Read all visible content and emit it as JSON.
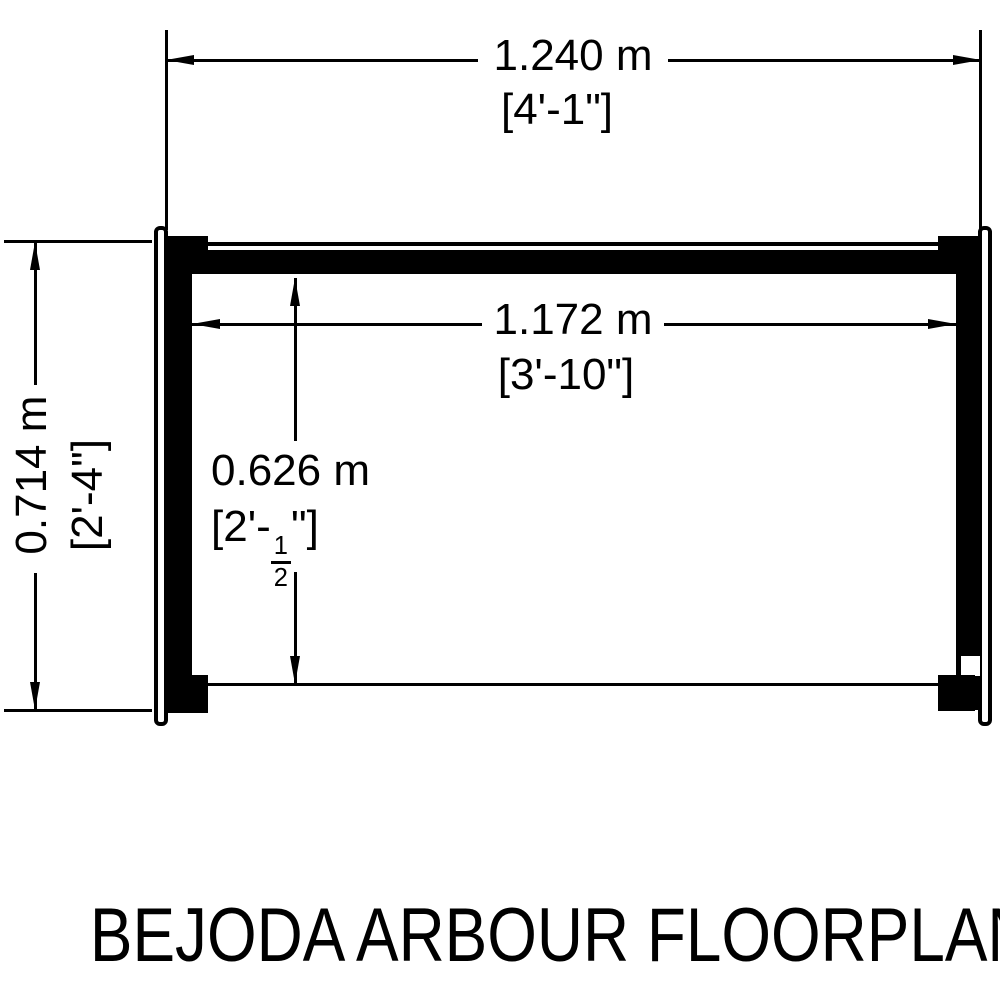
{
  "title": "BEJODA ARBOUR FLOORPLAN",
  "dims": {
    "overall_width_metric": "1.240 m",
    "overall_width_imperial": "[4'-1\"]",
    "inner_width_metric": "1.172 m",
    "inner_width_imperial": "[3'-10\"]",
    "overall_depth_metric": "0.714 m",
    "overall_depth_imperial": "[2'-4\"]",
    "inner_depth_metric": "0.626 m",
    "inner_depth_imperial_prefix": "[2'-",
    "inner_depth_frac_num": "1",
    "inner_depth_frac_den": "2",
    "inner_depth_imperial_suffix": "\"]"
  },
  "colors": {
    "ink": "#000000",
    "background": "#ffffff"
  }
}
